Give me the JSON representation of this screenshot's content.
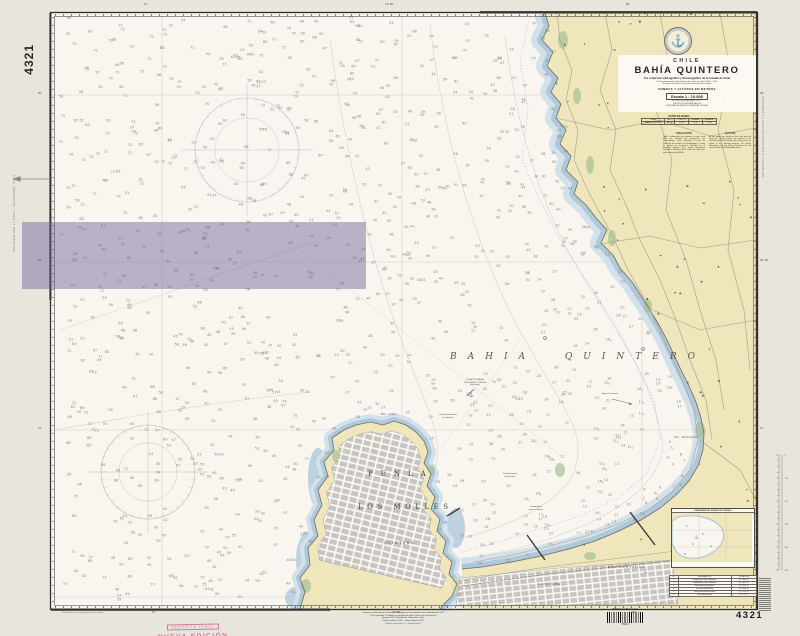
{
  "colors": {
    "paper": "#e8e5dd",
    "water": "#f8f6ef",
    "land": "#efe6bb",
    "dune": "#e8d9a4",
    "shallow1": "#adc9da",
    "shallow2": "#d3e1ea",
    "urban": "#c8c5c0",
    "green": "#a6c096",
    "purple_overlay": "rgba(104,88,148,0.44)",
    "frame": "#33322e",
    "sounding": "#8a8680",
    "contour": "#d3d0c7",
    "road": "#a59e8a",
    "stamp_pink": "#d0688a",
    "seal_gray": "#5a6476"
  },
  "frame": {
    "chart_number": "4321"
  },
  "seal": {
    "glyph": "⚓",
    "name": "shoa-seal"
  },
  "title_block": {
    "country": "CHILE",
    "title": "BAHÍA  QUINTERO",
    "subtitle": "Por el Servicio Hidrográfico y Oceanográfico de la Armada de Chile",
    "line2": "Del levantamiento hidrográfico efectuado los años 2000 - 2001",
    "line3": "Sondas reducidas al nivel de reducción de sondas",
    "units": "SONDAS Y ALTURAS EN METROS",
    "scale": "Escala 1 : 10.000",
    "scale_sub": "EN LATITUD MEDIA 32° 46' S",
    "projection": "PROYECCIÓN MERCATOR",
    "datum": "SISTEMA GEODÉSICO MUNDIAL WGS-84"
  },
  "tide_table": {
    "title": "DATOS DE MAREA",
    "headers": [
      "LUGAR",
      "LAT. S",
      "LONG. W",
      "PLEAMAR",
      "BAJAMAR"
    ],
    "row": [
      "BAHÍA QUINTERO",
      "32° 46'",
      "71° 29'",
      "1,6 m",
      "0,2 m"
    ]
  },
  "notes": {
    "left": {
      "title": "PRECAUCIÓN",
      "body": "Toda la información que aparece en esta carta debe ser utilizada con precaución. Las profundidades están reducidas al nivel de reducción de sondas. Los fondeaderos y zonas de espera se encuentran indicados en el diagrama adjunto. Para mayor información consulte el Derrotero de la Costa de Chile y las publicaciones del SHOA."
    },
    "right": {
      "title": "CAUTION",
      "body": "All the information shown on this chart must be used with caution. Depths are referred to the sounding datum. Anchoring and waiting areas are shown in the attached diagram. For further information see the Sailing Directions for the coast of Chile and SHOA publications."
    }
  },
  "sea_label": "BAHIA QUINTERO",
  "map_labels": [
    {
      "t": "PENLA",
      "x": 368,
      "y": 470,
      "fs": 7,
      "ls": 8,
      "it": false
    },
    {
      "t": "LOS MOLLES",
      "x": 358,
      "y": 503,
      "fs": 7,
      "ls": 4.5,
      "it": false
    },
    {
      "t": "QUINTERO",
      "x": 384,
      "y": 541,
      "fs": 3.2,
      "ls": 1.5,
      "it": false
    },
    {
      "t": "LONCURA",
      "x": 538,
      "y": 582,
      "fs": 3,
      "ls": 1,
      "it": false
    },
    {
      "t": "LAS VENTANAS",
      "x": 608,
      "y": 565,
      "fs": 3,
      "ls": 1,
      "it": false
    },
    {
      "t": "Pta. Liles",
      "x": 381,
      "y": 413,
      "fs": 2.6,
      "ls": 0.3,
      "it": true
    },
    {
      "t": "Pta. Ventanilla",
      "x": 674,
      "y": 436,
      "fs": 2.6,
      "ls": 0.3,
      "it": true
    }
  ],
  "water_notes": [
    {
      "x": 452,
      "y": 379,
      "w": 46,
      "lines": [
        "ZONA PROHIBIDA",
        "DE FONDEO Y PESCA",
        "(Ver Nota)"
      ]
    },
    {
      "x": 426,
      "y": 414,
      "w": 44,
      "lines": [
        "Cañería submarina",
        "(en desuso)"
      ]
    },
    {
      "x": 592,
      "y": 393,
      "w": 36,
      "lines": [
        "Boyas de amarre"
      ]
    },
    {
      "x": 490,
      "y": 473,
      "w": 40,
      "lines": [
        "Zona de espera",
        "de prácticos"
      ]
    },
    {
      "x": 516,
      "y": 506,
      "w": 40,
      "lines": [
        "Fondeadero",
        "naves menores"
      ]
    }
  ],
  "inset": {
    "title": "DIAGRAMA DE ZONAS DE FONDEO",
    "table_headers": [
      "N°",
      "DESIGNACIÓN",
      "SITUACIÓN"
    ],
    "table_rows": [
      [
        "1",
        "Fondeadero naves mayores",
        "32° 46,0' S"
      ],
      [
        "2",
        "Fondeadero naves menores",
        "32° 46,3' S"
      ],
      [
        "3",
        "Fondeadero de espera",
        "32° 46,6' S"
      ],
      [
        "4",
        "Zona de cuarentena",
        "32° 46,8' S"
      ],
      [
        "5",
        "Zona prohibida de fondeo",
        "32° 47,0' S"
      ],
      [
        "6",
        "Zona de prácticos",
        "32° 47,2' S"
      ]
    ]
  },
  "margin": {
    "top_labels": [
      {
        "x": 144,
        "t": "31'"
      },
      {
        "x": 385,
        "t": "71° 30'"
      },
      {
        "x": 626,
        "t": "29'"
      }
    ],
    "bottom_labels": [
      {
        "x": 152,
        "t": "31'"
      },
      {
        "x": 392,
        "t": "71° 30'"
      },
      {
        "x": 632,
        "t": "29'"
      }
    ],
    "lat_labels_right": [
      {
        "y": 92,
        "t": "45'"
      },
      {
        "y": 259,
        "t": "32° 46'"
      },
      {
        "y": 427,
        "t": "47'"
      }
    ],
    "lat_labels_left": [
      {
        "y": 92,
        "t": "45'"
      },
      {
        "y": 259,
        "t": "46'"
      },
      {
        "y": 427,
        "t": "47'"
      }
    ],
    "left_vertical_text": "PUBLICADA POR EL SHOA — VALPARAÍSO, CHILE",
    "right_vertical_text": "PROHIBIDA SU REPRODUCCIÓN SIN AUTORIZACIÓN",
    "imprint": [
      "Impreso y publicado por el Servicio Hidrográfico y Oceanográfico de la Armada de Chile",
      "© Es propiedad. Prohibida la reproducción total o parcial sin autorización",
      "Errázuriz 254, Playa Ancha, Valparaíso, Chile",
      "Primera edición 1998 — Nueva edición 2005",
      "Ventas: www.shoa.cl — shoa@shoa.cl"
    ],
    "bottom_left_note": "Válida hasta su reemplazo por nueva edición",
    "stamp_line1": "DEPÓSITO LEGAL",
    "stamp_line2": "NUEVA EDICIÓN",
    "barcode_label": "Biblioteca Nacional",
    "barcode_number": "75244"
  },
  "soundings": {
    "count": 1000,
    "seed": 4321,
    "min_depth": 2,
    "max_depth": 72
  }
}
